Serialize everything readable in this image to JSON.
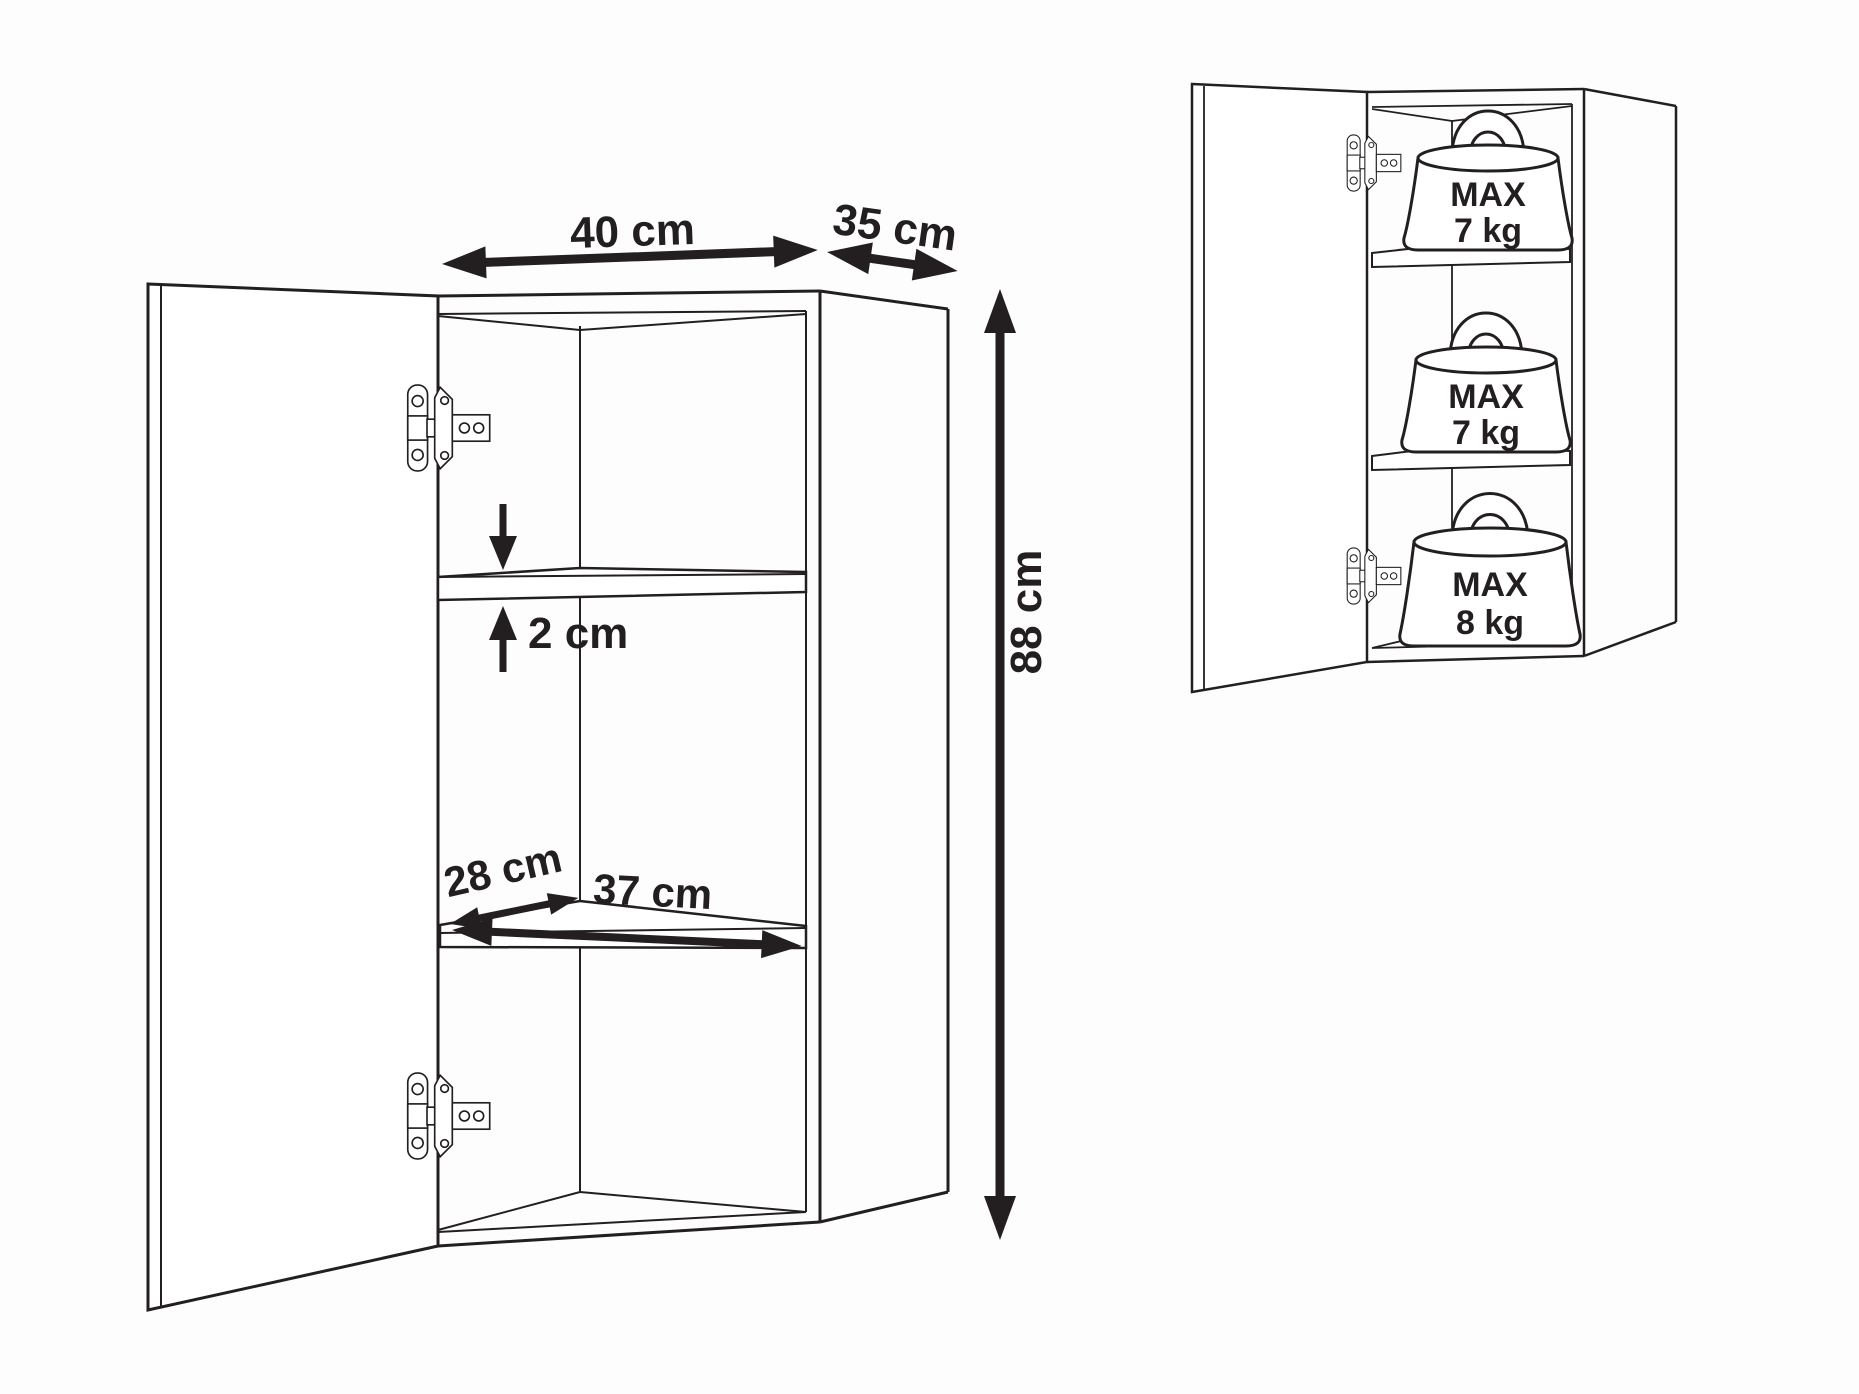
{
  "page": {
    "background": "#fdfdfd",
    "ink_color": "#231f20"
  },
  "left_diagram": {
    "labels": {
      "width": "40 cm",
      "depth": "35 cm",
      "height": "88 cm",
      "shelf_thickness": "2 cm",
      "shelf_clear_depth": "28 cm",
      "shelf_clear_width": "37 cm"
    }
  },
  "right_diagram": {
    "shelf_loads": [
      {
        "prefix": "MAX",
        "value": "7 kg"
      },
      {
        "prefix": "MAX",
        "value": "7 kg"
      },
      {
        "prefix": "MAX",
        "value": "8 kg"
      }
    ]
  }
}
